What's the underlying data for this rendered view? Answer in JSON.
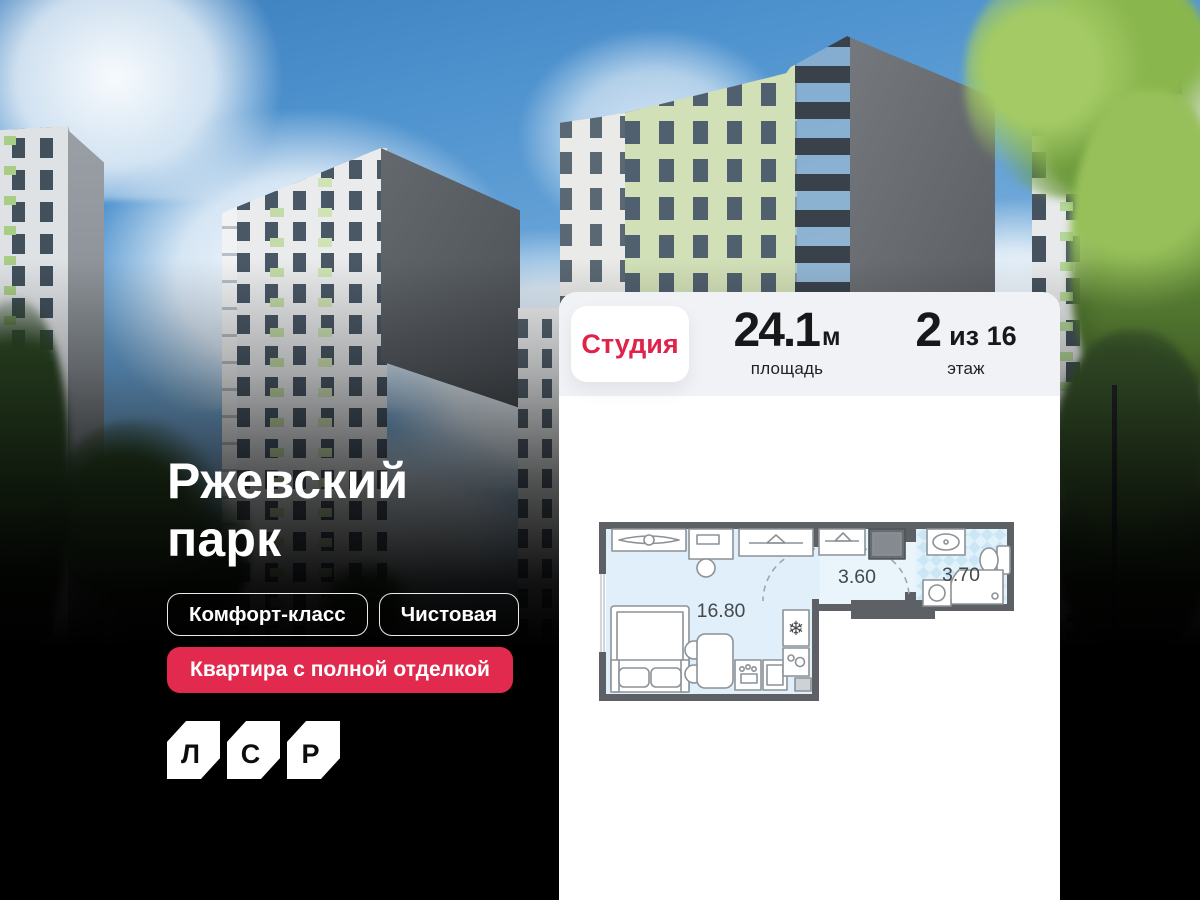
{
  "hero": {
    "title_line1": "Ржевский",
    "title_line2": "парк",
    "tags": [
      "Комфорт-класс",
      "Чистовая"
    ],
    "highlight": "Квартира с полной отделкой",
    "logo_letters": [
      "Л",
      "С",
      "Р"
    ]
  },
  "card": {
    "type": "Студия",
    "area": {
      "value": "24.1",
      "unit": "м",
      "caption": "площадь"
    },
    "floor": {
      "value": "2",
      "suffix": "из 16",
      "caption": "этаж"
    },
    "plan": {
      "rooms": [
        {
          "area": "16.80"
        },
        {
          "area": "3.60"
        },
        {
          "area": "3.70"
        }
      ]
    }
  },
  "icons": {
    "snowflake": "❄"
  },
  "colors": {
    "accent_red": "#E0234A",
    "badge_red": "#E2294E",
    "card_header": "#F1F2F5",
    "plan_wall": "#5D6165",
    "plan_floor": "#E0EFF9",
    "plan_bath": "#CBE7F5",
    "sky": "#4F93CF",
    "background": "#000000"
  }
}
